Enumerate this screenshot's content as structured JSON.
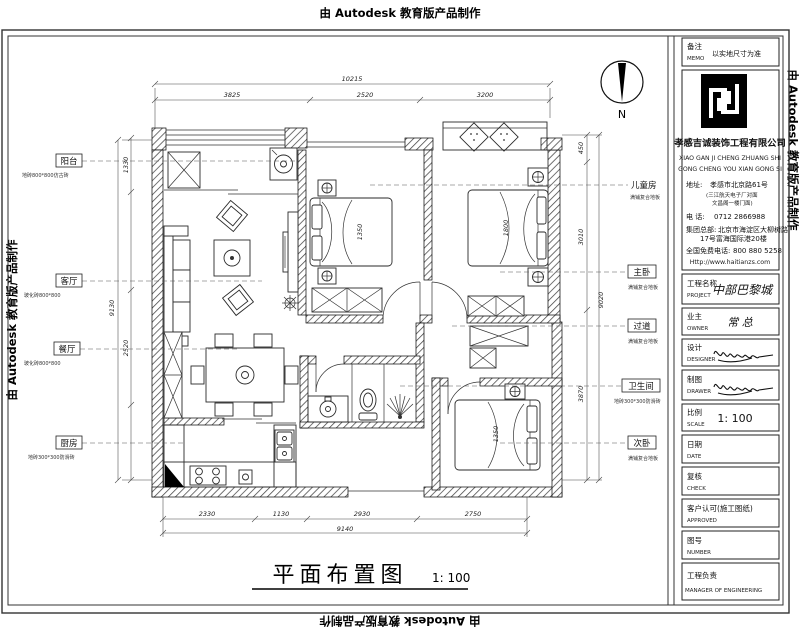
{
  "watermark": {
    "text": "由 Autodesk 教育版产品制作"
  },
  "north_label": "N",
  "drawing": {
    "title": "平面布置图",
    "title_scale": "1: 100",
    "rooms": [
      {
        "label": "阳台",
        "note": "地砖800*800仿古砖"
      },
      {
        "label": "客厅",
        "note": "玻化砖800*800"
      },
      {
        "label": "餐厅",
        "note": "玻化砖800*800"
      },
      {
        "label": "厨房",
        "note": "地砖300*300防滑砖"
      },
      {
        "label": "儿童房",
        "note": "满铺复合地板"
      },
      {
        "label": "主卧",
        "note": "满铺复合地板"
      },
      {
        "label": "过道",
        "note": "满铺复合地板"
      },
      {
        "label": "卫生间",
        "note": "地砖300*300防滑砖"
      },
      {
        "label": "次卧",
        "note": "满铺复合地板"
      }
    ],
    "beds": {
      "children": "1350",
      "master": "1800",
      "second": "1350"
    },
    "dims": {
      "top": {
        "total": "10215",
        "segs": [
          "3825",
          "2520",
          "3200"
        ]
      },
      "bottom": {
        "total": "9140",
        "segs": [
          "2330",
          "1130",
          "2930",
          "2750"
        ]
      },
      "left": {
        "total": "9130",
        "segs": [
          "1330",
          "2520"
        ]
      },
      "right": {
        "total": "9020",
        "segs": [
          "450",
          "3010",
          "3870"
        ]
      }
    }
  },
  "titleblock": {
    "memo": {
      "cn": "备注",
      "en": "MEMO",
      "value": "以实地尺寸为准"
    },
    "company": {
      "name": "孝感吉诚装饰工程有限公司",
      "pinyin1": "XIAO GAN JI CHENG ZHUANG SHI",
      "pinyin2": "GONG CHENG YOU XIAN GONG SI",
      "addr_label": "地址:",
      "addr": "孝感市北京路61号",
      "addr_note1": "(三江航天电子厂对面",
      "addr_note2": "文昌阁一楼门面)",
      "tel_label": "电  话:",
      "tel": "0712 2866988",
      "hq_label": "集团总部:",
      "hq1": "北京市海淀区大柳树路",
      "hq2": "17号富海国际港20楼",
      "hotline_label": "全国免费电话:",
      "hotline": "800 880 5258",
      "website": "Http://www.haitianzs.com"
    },
    "fields": [
      {
        "cn": "工程名称",
        "en": "PROJECT",
        "value": "中部巴黎城"
      },
      {
        "cn": "业主",
        "en": "OWNER",
        "value": "常 总"
      },
      {
        "cn": "设计",
        "en": "DESIGNER",
        "value": ""
      },
      {
        "cn": "制图",
        "en": "DRAWER",
        "value": ""
      },
      {
        "cn": "比例",
        "en": "SCALE",
        "value": "1: 100"
      },
      {
        "cn": "日期",
        "en": "DATE",
        "value": ""
      },
      {
        "cn": "复核",
        "en": "CHECK",
        "value": ""
      },
      {
        "cn": "客户认可(施工图纸)",
        "en": "APPROVED",
        "value": ""
      },
      {
        "cn": "图号",
        "en": "NUMBER",
        "value": ""
      },
      {
        "cn": "工程负责",
        "en": "MANAGER OF ENGINEERING",
        "value": ""
      }
    ]
  }
}
